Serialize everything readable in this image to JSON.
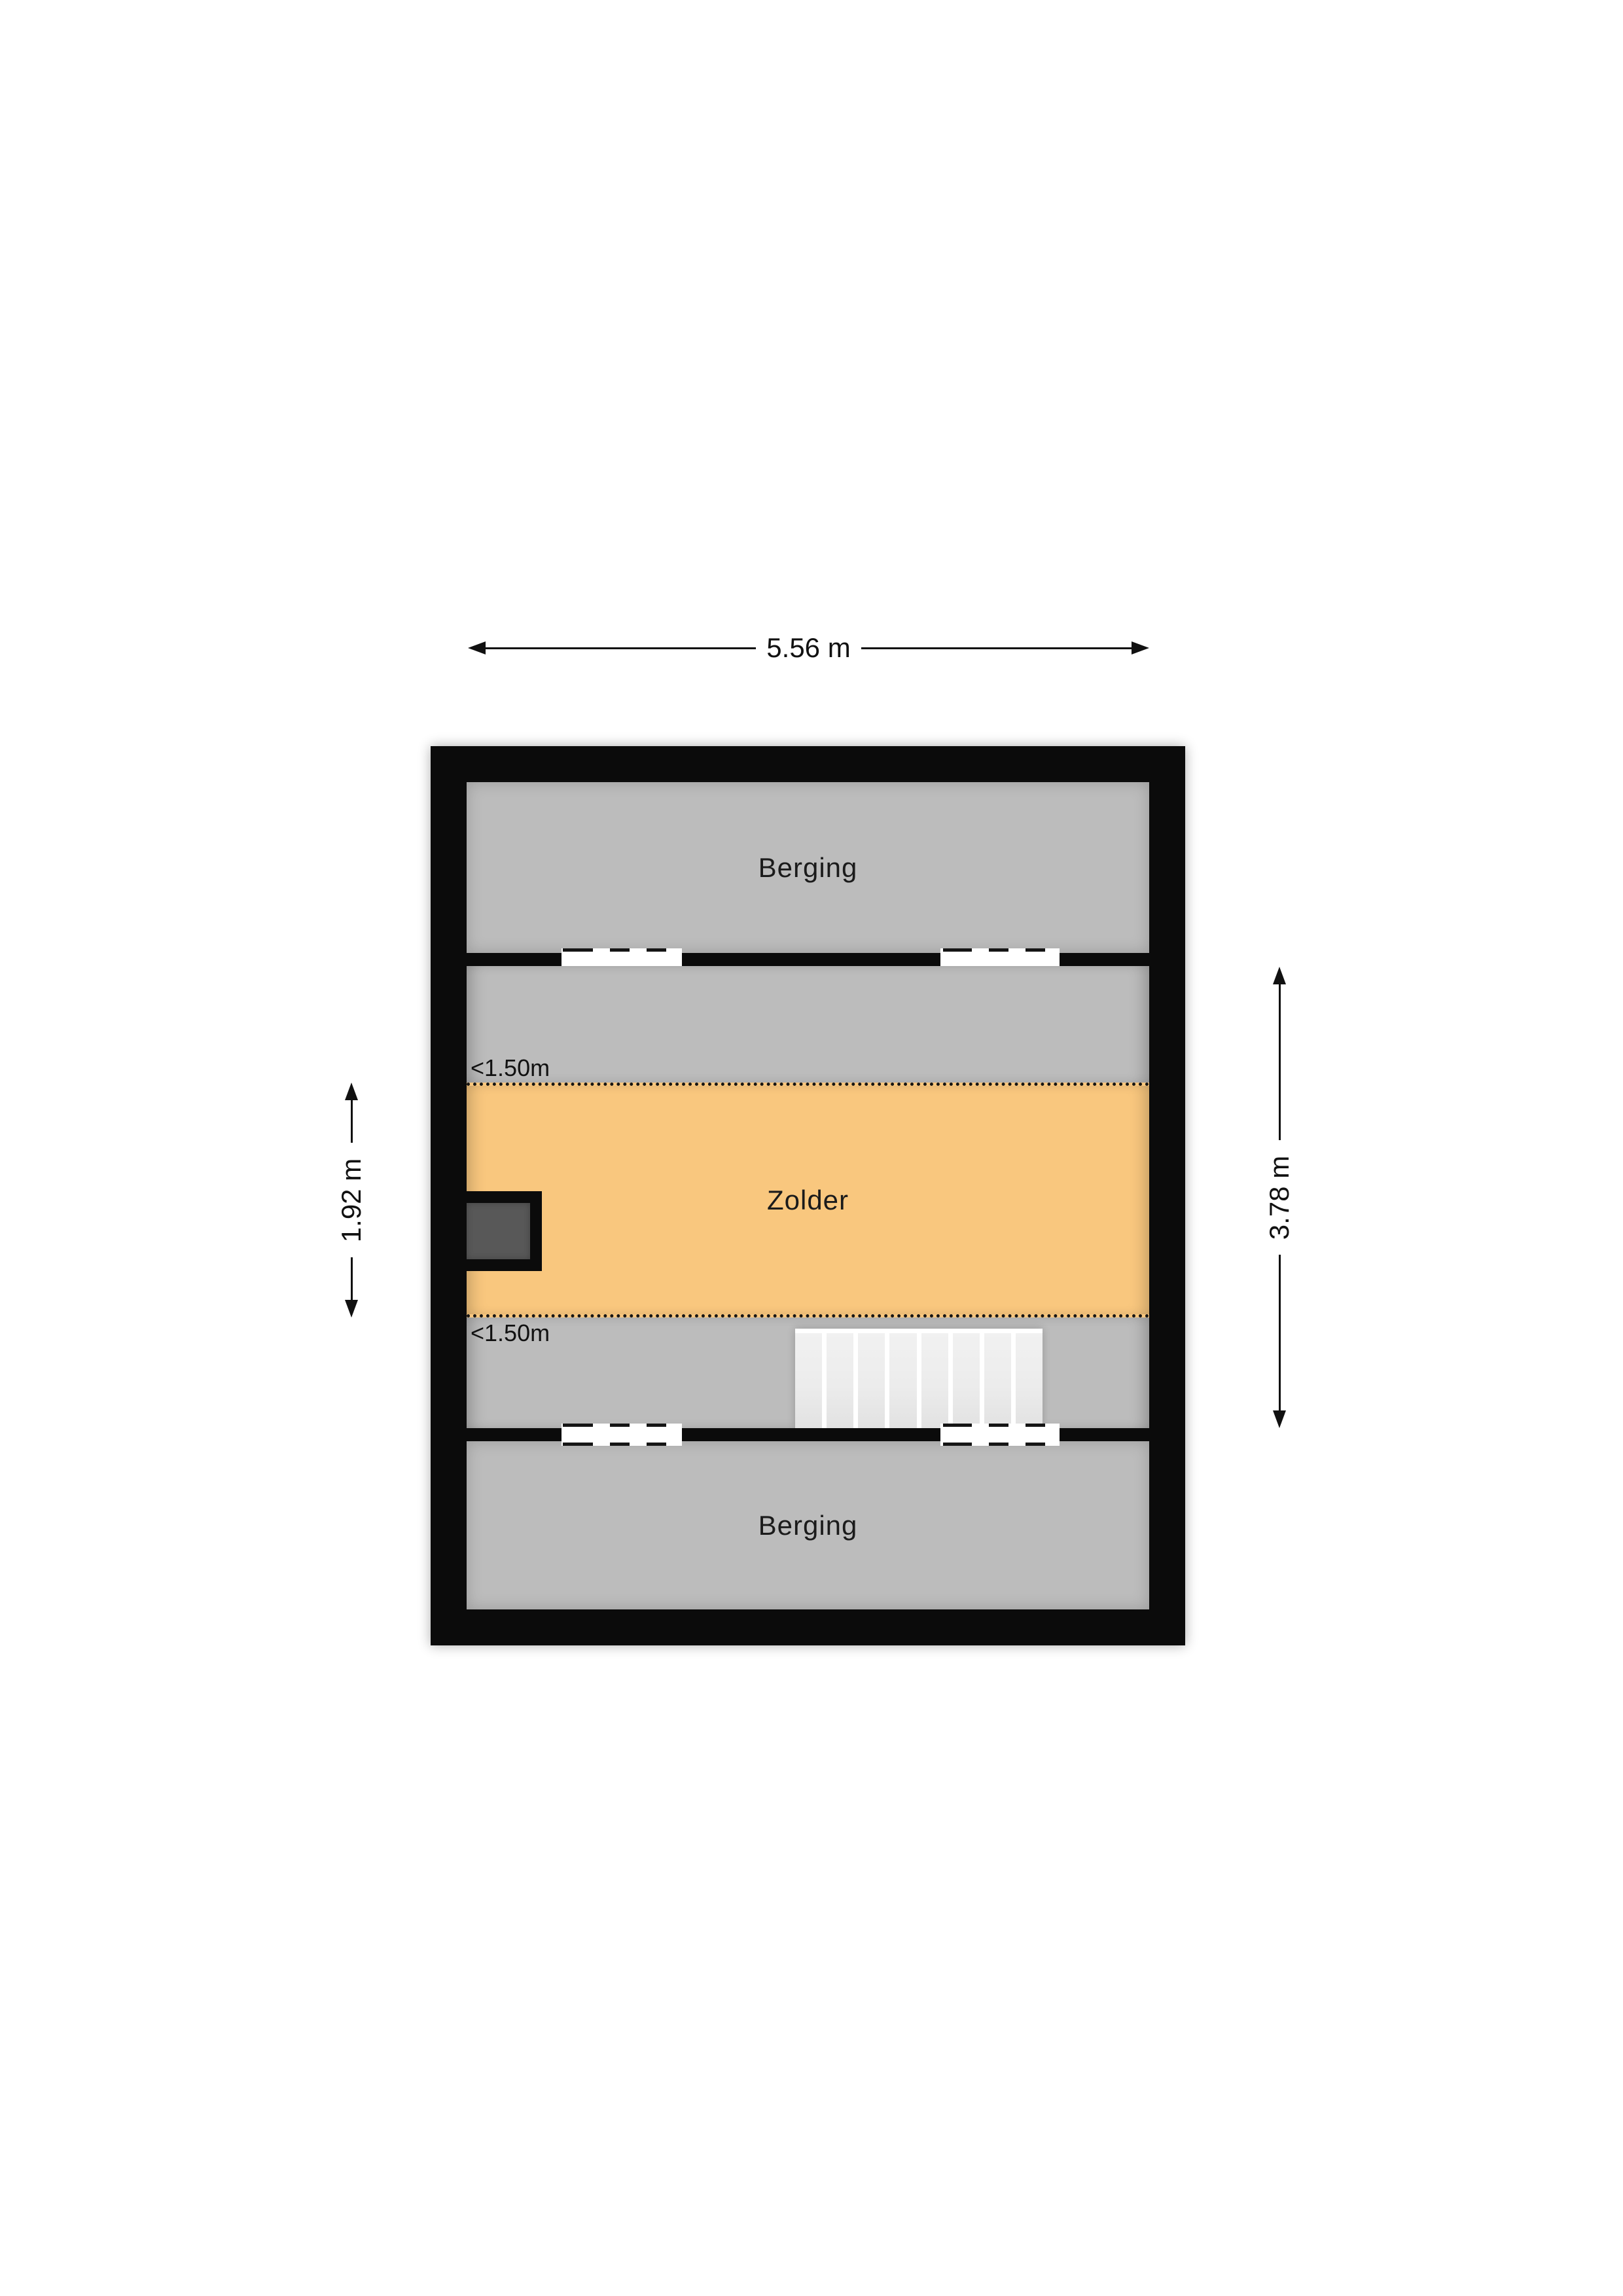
{
  "figure": {
    "type": "floorplan",
    "floor_name": "Zolder (attic) floor plan"
  },
  "dimensions": {
    "width_label": "5.56 m",
    "left_height_label": "1.92 m",
    "right_height_label": "3.78 m"
  },
  "room_labels": {
    "berging_top": "Berging",
    "zolder": "Zolder",
    "berging_bottom": "Berging"
  },
  "annotations": {
    "low_ceiling_top": "<1.50m",
    "low_ceiling_bottom": "<1.50m"
  },
  "stairs": {
    "step_count": 8
  },
  "colors": {
    "wall": "#0b0b0b",
    "room_gray": "#bcbcbc",
    "zolder_orange": "#f9c77e",
    "chimney_dark_gray": "#585858",
    "stair_step": "#ececec",
    "window_white": "#ffffff",
    "page_background": "#ffffff",
    "line_and_text": "#111111"
  }
}
